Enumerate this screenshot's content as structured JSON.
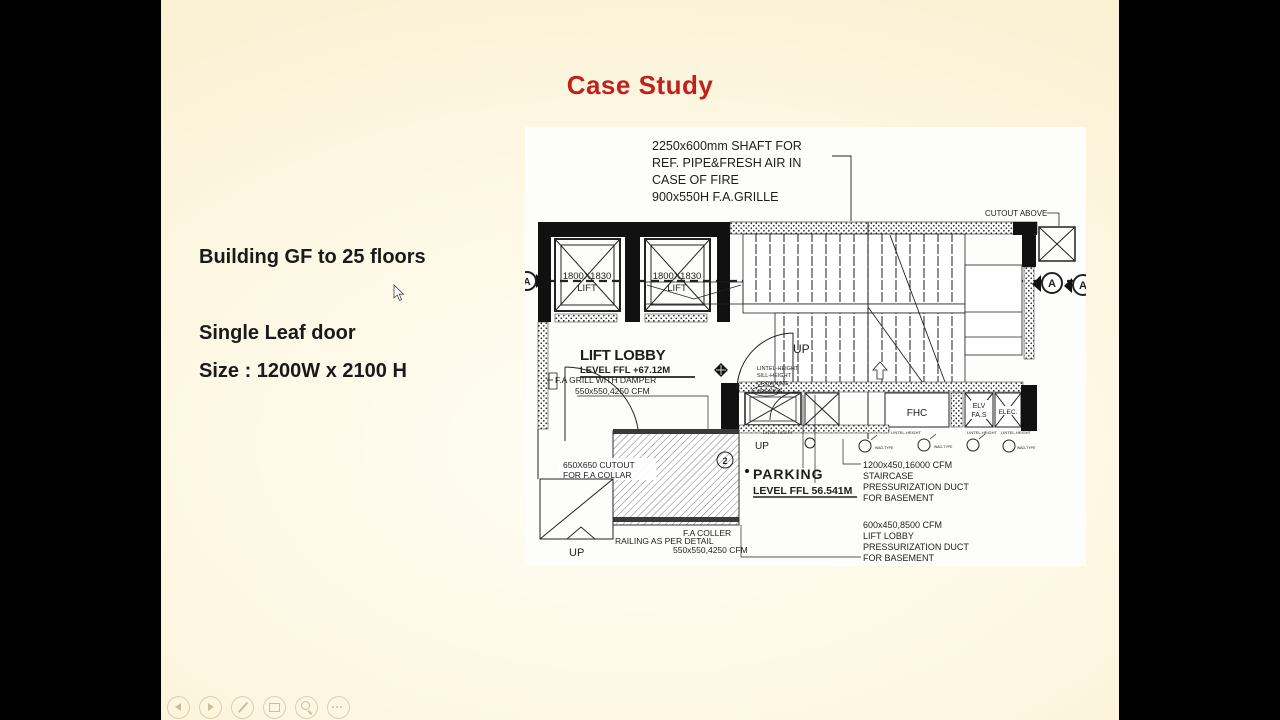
{
  "colors": {
    "accent_red": "#c1211b",
    "slide_bg": "#fdf6e0",
    "letterbox": "#000000",
    "ink": "#1d1d1d"
  },
  "slide": {
    "title": "Case Study",
    "bullets": [
      "Building GF to 25 floors",
      "Single Leaf door",
      "Size : 1200W x 2100 H"
    ]
  },
  "toolbar": {
    "icons": [
      "previous-slide",
      "next-slide",
      "pen-annotate",
      "display-settings",
      "zoom",
      "more-options"
    ]
  },
  "drawing": {
    "shaft_note": [
      "2250x600mm SHAFT FOR",
      "REF. PIPE&FRESH AIR IN",
      "CASE OF FIRE",
      "900x550H F.A.GRILLE"
    ],
    "cutout_above": "CUTOUT ABOVE",
    "lift_size": "1800X1830",
    "lift_label": "LIFT",
    "lift_lobby": "LIFT LOBBY",
    "lift_lobby_level": "LEVEL FFL +67.12M",
    "fa_grill": [
      "F.A GRILL WITH DAMPER",
      "550x550,4250 CFM"
    ],
    "up": "UP",
    "cutout_fa": [
      "650X650 CUTOUT",
      "FOR F.A COLLAR"
    ],
    "railing": "RAILING AS PER DETAIL",
    "fa_coller": [
      "F.A COLLER",
      "550x550,4250 CFM"
    ],
    "parking": "PARKING",
    "parking_level": "LEVEL FFL 56.541M",
    "stair_duct": [
      "1200x450,16000 CFM",
      "STAIRCASE",
      "PRESSURIZATION DUCT",
      "FOR BASEMENT"
    ],
    "lobby_duct": [
      "600x450,8500 CFM",
      "LIFT LOBBY",
      "PRESSURIZATION DUCT",
      "FOR BASEMENT"
    ],
    "rooms": {
      "fhc": "FHC",
      "elv": "ELV",
      "fas": "FA.S",
      "elec": "ELEC."
    },
    "lintel_note": [
      "LINTEL-HEIGHT",
      "SILL-HEIGHT",
      "CROWNING",
      "OPENING"
    ],
    "small_note": "LINTEL-HEIGHT",
    "pipe_note": "WAD-TYPE",
    "section_marker": "A",
    "stair_number": "2"
  }
}
